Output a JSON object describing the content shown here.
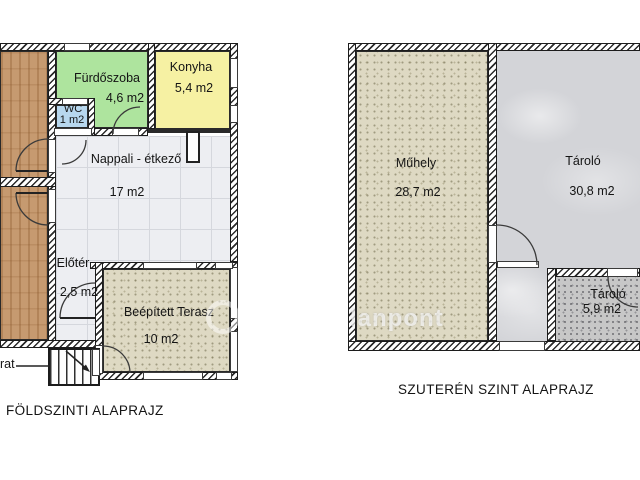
{
  "ground_plan": {
    "caption": "FÖLDSZINTI ALAPRAJZ",
    "stairs_label": "rat",
    "rooms": {
      "furdoszoba": {
        "name": "Fürdőszoba",
        "area": "4,6 m2"
      },
      "wc": {
        "name": "WC",
        "area": "1 m2"
      },
      "konyha": {
        "name": "Konyha",
        "area": "5,4 m2"
      },
      "nappali": {
        "name": "Nappali - étkező",
        "area": "17 m2"
      },
      "eloter": {
        "name": "Előtér",
        "area": "2,5 m2"
      },
      "terasz": {
        "name": "Beépített Terasz",
        "area": "10 m2"
      }
    }
  },
  "basement_plan": {
    "caption": "SZUTERÉN SZINT ALAPRAJZ",
    "rooms": {
      "muhely": {
        "name": "Műhely",
        "area": "28,7 m2"
      },
      "tarolo_large": {
        "name": "Tároló",
        "area": "30,8 m2"
      },
      "tarolo_small": {
        "name": "Tároló",
        "area": "5,9 m2"
      }
    }
  },
  "watermark": {
    "text": "lanpont"
  },
  "colors": {
    "bathroom": "#aee49e",
    "kitchen": "#f6f1a3",
    "wc": "#b7d7ee",
    "wood": "#c69a70",
    "tile": "#edeef2",
    "terrace": "#ded9c3",
    "storage_large": "#d3d4d8",
    "storage_small": "#c7c7c7",
    "wall_line": "#2b2b2b",
    "text": "#141414"
  }
}
